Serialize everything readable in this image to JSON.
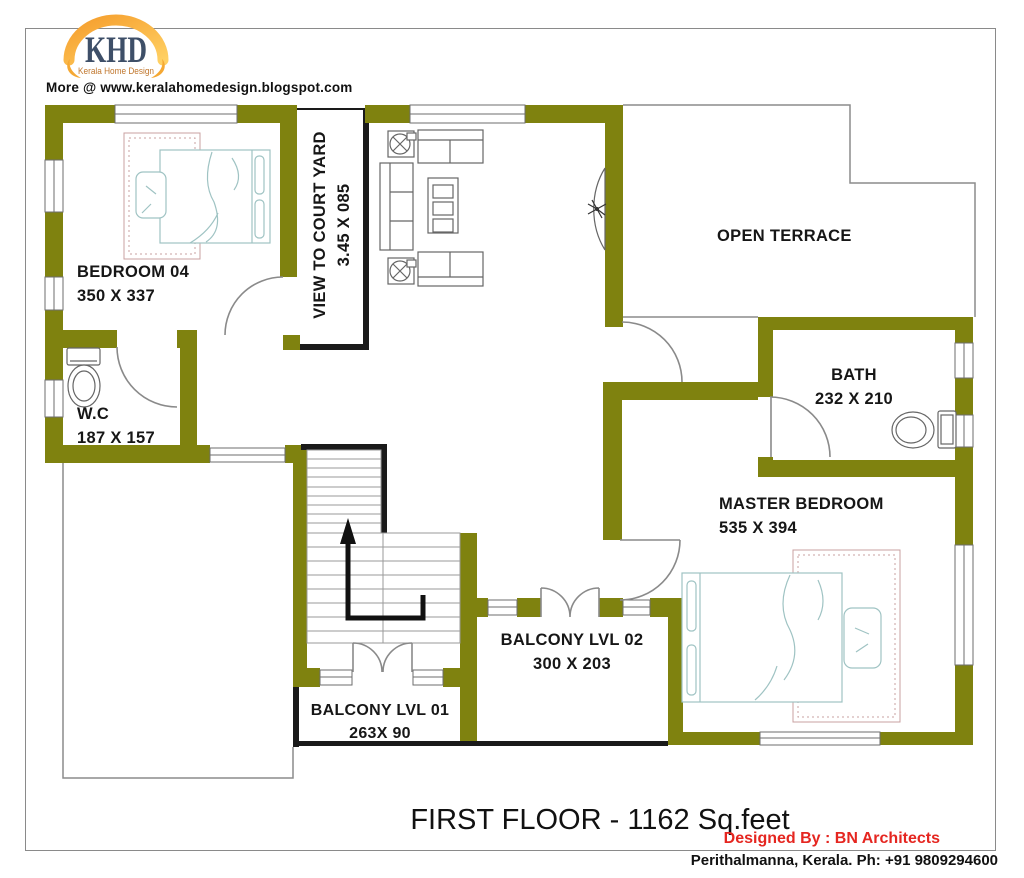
{
  "branding": {
    "logo_text": "KHD",
    "logo_subtext": "Kerala Home Design",
    "source_line": "More @ www.keralahomedesign.blogspot.com"
  },
  "rooms": {
    "bedroom04": {
      "label": "BEDROOM 04",
      "dims": "350 X 337"
    },
    "courtyard": {
      "label": "VIEW TO COURT YARD",
      "dims": "3.45 X 085"
    },
    "terrace": {
      "label": "OPEN TERRACE"
    },
    "bath": {
      "label": "BATH",
      "dims": "232 X 210"
    },
    "wc": {
      "label": "W.C",
      "dims": "187 X 157"
    },
    "master": {
      "label": "MASTER BEDROOM",
      "dims": "535 X 394"
    },
    "balcony1": {
      "label": "BALCONY LVL 01",
      "dims": "263X 90"
    },
    "balcony2": {
      "label": "BALCONY LVL 02",
      "dims": "300 X 203"
    }
  },
  "footer": {
    "title": "FIRST FLOOR - 1162 Sq.feet",
    "designer": "Designed By : BN Architects",
    "contact": "Perithalmanna, Kerala. Ph: +91 9809294600"
  },
  "colors": {
    "wall": "#7f820f",
    "frame_black": "#1a1a1a",
    "outline_gray": "#8c8c8c",
    "furniture_line": "#9fc3c3",
    "rug_line": "#c8a0a0",
    "accent_red": "#e52620",
    "logo_blue": "#3e4f68",
    "logo_orange": "#f0a233"
  }
}
